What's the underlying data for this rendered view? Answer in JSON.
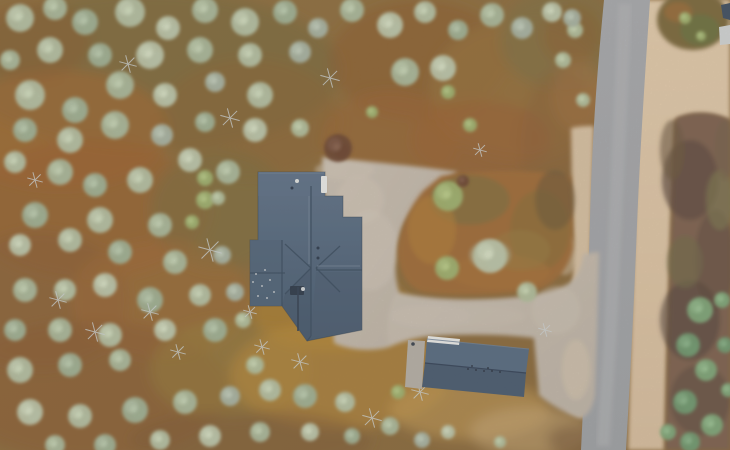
{
  "scene": {
    "width": 730,
    "height": 450,
    "description": "Top-down drone photo: dark-roofed cabin and small garage with light gravel yard and driveway, connecting to a gray gravel road on the right, surrounded by autumn pine forest and heathland"
  },
  "palette": {
    "ground_base_1": "#8e6f40",
    "ground_base_2": "#87673c",
    "road_1": "#a6a8ad",
    "road_2": "#9da0a5",
    "road_stripe": "#b6b8bb",
    "sand_left": "#d5bfa2",
    "sand_right_1": "#e1caac",
    "sand_right_2": "#d6bd9f",
    "gravel_1": "#c7bdb1",
    "gravel_2": "#bcb2a6",
    "island_base": "#9e6a38",
    "right_heath": "#7b6050",
    "corner_veg_1": "#7a683e",
    "corner_veg_2": "#6b713f",
    "corner_veg_3": "#9a6c3a",
    "roof_1": "#5f7289",
    "roof_2": "#51657c",
    "roof_3": "#475a70",
    "ridge": "#3a4c62",
    "roof_highlight": "#78899c",
    "garage_upper": "#566a82",
    "garage_lower": "#485a70",
    "white_detail": "#e8e9e8",
    "pad": "#b3aea6",
    "dead_tree": "#ccd2d4",
    "equipment_dark": "#2b3648",
    "tree_colors": [
      "#b3bfa3",
      "#a9b79b",
      "#9fb095",
      "#bac4aa",
      "#a6b2a2",
      "#b0bd9c",
      "#7da579",
      "#6f9870",
      "#9db06f",
      "#6b4634"
    ]
  },
  "paths": {
    "yard": "M322,157 C365,161 425,167 458,172 C440,183 414,201 402,228 C395,250 393,272 399,292 C403,312 397,332 389,347 C372,352 348,350 334,343 Z",
    "band": "M389,347 C385,324 389,305 397,292 C425,299 465,301 505,298 C535,296 555,291 568,284 C578,277 582,266 583,254 L599,252 L597,330 L595,395 C592,410 587,417 579,418 C563,412 548,403 539,395 L534,338 C505,334 465,334 432,336 C416,337 400,342 389,347 Z",
    "sand_left": "M571,128 C580,126 587,126 594,126 L591,240 L588,330 L585,418 C579,416 573,413 568,410 L571,330 L574,250 L572,190 Z",
    "sand_right": "M645,0 L730,0 L730,120 C710,112 690,112 674,120 C670,230 667,330 664,450 L628,450 C631,340 634,220 638,110 C640,70 643,30 645,0 Z",
    "road": "M604,0 L650,0 C645,75 640,150 637,225 C634,305 630,380 626,450 L581,450 C585,370 588,295 590,218 C592,140 597,72 604,0 Z",
    "road_center": "M625,4 C620,120 615,240 610,340 C607,390 605,420 603,446",
    "right_heath": "M676,118 C695,110 715,112 730,120 L730,450 L666,450 C668,340 671,230 676,118 Z",
    "island": "M441,176 C478,169 540,169 571,177 L573,248 C569,267 559,280 542,288 C510,295 462,297 423,292 C406,287 399,271 398,251 C400,229 410,205 424,190 Z",
    "house_footprint": "M258,172 L325,172 L325,196 L343,196 L343,217 L362,217 L362,330 L307,341 L282,306 L250,306 L250,240 L258,240 Z",
    "house_se_shade": "M316,272 L362,272 L362,330 L311,337 Z",
    "house_sw_shade": "M311,268 L285,294 L282,306 L307,341 L311,337 Z",
    "house_wing": "M250,240 L282,240 L282,306 L250,306 Z",
    "house_top": "M258,172 L325,172 L325,196 L258,196 Z",
    "garage_upper": "M427,339 L529,349 L526,373 L425,363 Z",
    "garage_lower": "M425,363 L526,373 L524,397 L422,387 Z",
    "garage_white": "M428,336 L460,339 L459,345 L427,342 Z",
    "garage_pad": "M408,340 L425,341 L422,389 L405,387 Z",
    "neighbor_roof": "M721,5 L730,3 L730,20 L723,18 Z",
    "neighbor_panel": "M719,27 L730,25 L730,44 L720,45 Z"
  },
  "ground_patches": [
    [
      150,
      70,
      190,
      80,
      "#7b6a3c",
      0.75
    ],
    [
      60,
      130,
      110,
      60,
      "#a4672f",
      0.6
    ],
    [
      250,
      120,
      90,
      60,
      "#8a6434",
      0.55
    ],
    [
      420,
      60,
      90,
      60,
      "#8d5a2e",
      0.5
    ],
    [
      520,
      90,
      90,
      70,
      "#96713d",
      0.7
    ],
    [
      560,
      40,
      60,
      50,
      "#7d6f45",
      0.6
    ],
    [
      480,
      140,
      70,
      40,
      "#9c5c30",
      0.5
    ],
    [
      90,
      210,
      120,
      70,
      "#9a5f2e",
      0.6
    ],
    [
      220,
      210,
      70,
      60,
      "#7a6d3f",
      0.55
    ],
    [
      40,
      300,
      90,
      70,
      "#8a5c34",
      0.55
    ],
    [
      160,
      300,
      90,
      60,
      "#a06a33",
      0.5
    ],
    [
      90,
      390,
      140,
      70,
      "#8a5c34",
      0.6
    ],
    [
      230,
      370,
      80,
      50,
      "#97803d",
      0.5
    ],
    [
      330,
      310,
      80,
      40,
      "#b5862f",
      0.6
    ],
    [
      340,
      375,
      110,
      55,
      "#b98a3c",
      0.6
    ],
    [
      470,
      410,
      80,
      30,
      "#c29a55",
      0.6
    ],
    [
      530,
      432,
      60,
      25,
      "#c7a878",
      0.55
    ],
    [
      390,
      140,
      70,
      50,
      "#9c6432",
      0.5
    ],
    [
      560,
      150,
      40,
      80,
      "#8a6038",
      0.5
    ],
    [
      572,
      35,
      30,
      30,
      "#8a5e32",
      0.55
    ],
    [
      578,
      95,
      26,
      36,
      "#a27040",
      0.5
    ],
    [
      250,
      440,
      120,
      30,
      "#7e5a36",
      0.5
    ],
    [
      30,
      40,
      60,
      40,
      "#8a5c30",
      0.5
    ],
    [
      360,
      230,
      40,
      60,
      "#8a7340",
      0.45
    ],
    [
      575,
      440,
      28,
      16,
      "#7a5a3c",
      0.6
    ]
  ],
  "island_patches": [
    [
      470,
      200,
      40,
      25,
      "#7f6f3e",
      0.7
    ],
    [
      540,
      230,
      30,
      40,
      "#8a6d3a",
      0.7
    ],
    [
      500,
      272,
      50,
      18,
      "#a4713a",
      0.7
    ],
    [
      555,
      200,
      20,
      30,
      "#6d583a",
      0.6
    ],
    [
      432,
      230,
      24,
      34,
      "#b07e38",
      0.6
    ],
    [
      520,
      250,
      30,
      20,
      "#967a40",
      0.5
    ],
    [
      490,
      255,
      20,
      14,
      "#b5bfa3",
      0.55
    ]
  ],
  "right_heath_patches": [
    [
      690,
      180,
      28,
      40,
      "#5e4a3e",
      0.7
    ],
    [
      715,
      260,
      20,
      50,
      "#665042",
      0.7
    ],
    [
      690,
      320,
      30,
      40,
      "#55463c",
      0.6
    ],
    [
      700,
      400,
      30,
      35,
      "#604c40",
      0.6
    ],
    [
      720,
      200,
      14,
      30,
      "#7d7a52",
      0.6
    ],
    [
      685,
      262,
      18,
      26,
      "#716b4a",
      0.6
    ],
    [
      672,
      150,
      12,
      30,
      "#6b563f",
      0.6
    ],
    [
      725,
      150,
      10,
      30,
      "#74604a",
      0.5
    ]
  ],
  "corner_veg": [
    [
      693,
      20,
      36,
      30,
      "#7a683e",
      1
    ],
    [
      700,
      30,
      20,
      16,
      "#6b713f",
      0.9
    ],
    [
      678,
      12,
      14,
      10,
      "#9a6c3a",
      0.8
    ]
  ],
  "gravel_blotches": [
    [
      370,
      250,
      28,
      40,
      "#cfc6ba",
      0.5
    ],
    [
      430,
      316,
      40,
      12,
      "#ccc2b6",
      0.5
    ],
    [
      475,
      316,
      50,
      10,
      "#c9bfb2",
      0.4
    ],
    [
      360,
      200,
      24,
      24,
      "#d2c8bb",
      0.45
    ],
    [
      556,
      310,
      24,
      24,
      "#cdc3b6",
      0.4
    ],
    [
      576,
      370,
      14,
      30,
      "#d6c5af",
      0.5
    ],
    [
      345,
      170,
      30,
      10,
      "#cfc5b8",
      0.5
    ],
    [
      565,
      255,
      12,
      20,
      "#d8c6ae",
      0.5
    ]
  ],
  "trees": [
    [
      20,
      18,
      14,
      0
    ],
    [
      55,
      8,
      12,
      1
    ],
    [
      85,
      22,
      13,
      2
    ],
    [
      130,
      12,
      15,
      0
    ],
    [
      168,
      28,
      12,
      3
    ],
    [
      205,
      10,
      13,
      1
    ],
    [
      245,
      22,
      14,
      0
    ],
    [
      285,
      12,
      12,
      2
    ],
    [
      318,
      28,
      10,
      4
    ],
    [
      352,
      10,
      12,
      1
    ],
    [
      390,
      25,
      13,
      3
    ],
    [
      425,
      12,
      11,
      0
    ],
    [
      458,
      30,
      10,
      2
    ],
    [
      492,
      15,
      12,
      1
    ],
    [
      522,
      28,
      11,
      4
    ],
    [
      552,
      12,
      10,
      3
    ],
    [
      10,
      60,
      10,
      1
    ],
    [
      50,
      50,
      13,
      0
    ],
    [
      100,
      55,
      12,
      2
    ],
    [
      150,
      55,
      14,
      3
    ],
    [
      200,
      50,
      13,
      1
    ],
    [
      250,
      55,
      12,
      0
    ],
    [
      300,
      52,
      11,
      4
    ],
    [
      575,
      30,
      8,
      5
    ],
    [
      30,
      95,
      15,
      0
    ],
    [
      75,
      110,
      13,
      2
    ],
    [
      120,
      85,
      14,
      1
    ],
    [
      165,
      95,
      12,
      3
    ],
    [
      215,
      82,
      10,
      4
    ],
    [
      260,
      95,
      13,
      0
    ],
    [
      405,
      72,
      14,
      1
    ],
    [
      443,
      68,
      13,
      3
    ],
    [
      448,
      92,
      7,
      8
    ],
    [
      25,
      130,
      12,
      2
    ],
    [
      70,
      140,
      13,
      0
    ],
    [
      115,
      125,
      14,
      1
    ],
    [
      162,
      135,
      11,
      4
    ],
    [
      205,
      122,
      10,
      2
    ],
    [
      255,
      130,
      12,
      3
    ],
    [
      300,
      128,
      9,
      5
    ],
    [
      338,
      148,
      14,
      9
    ],
    [
      372,
      112,
      6,
      8
    ],
    [
      563,
      60,
      8,
      5
    ],
    [
      572,
      18,
      9,
      4
    ],
    [
      583,
      100,
      7,
      5
    ],
    [
      15,
      162,
      11,
      0
    ],
    [
      60,
      172,
      13,
      1
    ],
    [
      95,
      185,
      12,
      2
    ],
    [
      140,
      180,
      13,
      0
    ],
    [
      190,
      160,
      12,
      3
    ],
    [
      228,
      172,
      12,
      1
    ],
    [
      35,
      215,
      13,
      2
    ],
    [
      100,
      220,
      13,
      0
    ],
    [
      160,
      225,
      12,
      1
    ],
    [
      205,
      200,
      9,
      8
    ],
    [
      20,
      245,
      11,
      3
    ],
    [
      70,
      240,
      12,
      0
    ],
    [
      120,
      252,
      12,
      2
    ],
    [
      175,
      262,
      12,
      1
    ],
    [
      222,
      255,
      9,
      4
    ],
    [
      205,
      178,
      8,
      8
    ],
    [
      218,
      198,
      7,
      5
    ],
    [
      192,
      222,
      7,
      8
    ],
    [
      25,
      290,
      12,
      1
    ],
    [
      65,
      290,
      11,
      0
    ],
    [
      105,
      285,
      12,
      3
    ],
    [
      150,
      300,
      13,
      2
    ],
    [
      200,
      295,
      11,
      0
    ],
    [
      235,
      292,
      9,
      4
    ],
    [
      15,
      330,
      11,
      2
    ],
    [
      60,
      330,
      12,
      1
    ],
    [
      110,
      335,
      12,
      0
    ],
    [
      165,
      330,
      11,
      3
    ],
    [
      215,
      330,
      12,
      2
    ],
    [
      243,
      320,
      8,
      5
    ],
    [
      20,
      370,
      13,
      0
    ],
    [
      70,
      365,
      12,
      2
    ],
    [
      120,
      360,
      11,
      1
    ],
    [
      30,
      412,
      13,
      3
    ],
    [
      80,
      416,
      12,
      0
    ],
    [
      135,
      410,
      13,
      2
    ],
    [
      185,
      402,
      12,
      1
    ],
    [
      230,
      396,
      10,
      4
    ],
    [
      255,
      365,
      9,
      5
    ],
    [
      270,
      390,
      11,
      0
    ],
    [
      305,
      396,
      12,
      2
    ],
    [
      260,
      432,
      10,
      1
    ],
    [
      210,
      436,
      11,
      3
    ],
    [
      160,
      440,
      10,
      0
    ],
    [
      105,
      445,
      11,
      2
    ],
    [
      55,
      445,
      10,
      1
    ],
    [
      310,
      432,
      9,
      3
    ],
    [
      345,
      402,
      10,
      0
    ],
    [
      352,
      436,
      8,
      2
    ],
    [
      390,
      426,
      9,
      1
    ],
    [
      398,
      392,
      7,
      8
    ],
    [
      422,
      440,
      8,
      4
    ],
    [
      448,
      432,
      7,
      3
    ],
    [
      500,
      442,
      6,
      5
    ],
    [
      448,
      196,
      15,
      8
    ],
    [
      490,
      256,
      17,
      3
    ],
    [
      447,
      268,
      12,
      8
    ],
    [
      527,
      292,
      10,
      5
    ],
    [
      463,
      181,
      6,
      9
    ],
    [
      470,
      125,
      7,
      8
    ],
    [
      700,
      310,
      13,
      6
    ],
    [
      688,
      345,
      12,
      7
    ],
    [
      706,
      370,
      11,
      6
    ],
    [
      685,
      402,
      12,
      7
    ],
    [
      712,
      425,
      11,
      6
    ],
    [
      690,
      442,
      10,
      7
    ],
    [
      668,
      432,
      8,
      6
    ],
    [
      725,
      345,
      8,
      7
    ],
    [
      722,
      300,
      8,
      6
    ],
    [
      728,
      390,
      7,
      6
    ],
    [
      685,
      18,
      6,
      8
    ],
    [
      701,
      36,
      5,
      8
    ]
  ],
  "dead_trees": [
    [
      210,
      250,
      12
    ],
    [
      95,
      332,
      10
    ],
    [
      150,
      312,
      9
    ],
    [
      230,
      118,
      10
    ],
    [
      128,
      64,
      9
    ],
    [
      330,
      78,
      10
    ],
    [
      58,
      300,
      9
    ],
    [
      262,
      347,
      8
    ],
    [
      300,
      362,
      9
    ],
    [
      372,
      418,
      10
    ],
    [
      420,
      392,
      9
    ],
    [
      178,
      352,
      8
    ],
    [
      480,
      150,
      7
    ],
    [
      545,
      330,
      7
    ],
    [
      35,
      180,
      8
    ],
    [
      250,
      312,
      7
    ]
  ],
  "house": {
    "ridges": [
      "M311,186 L311,336",
      "M311,268 L285,244",
      "M311,268 L285,294",
      "M316,268 L340,246",
      "M316,268 L340,292",
      "M316,270 L362,270",
      "M250,273 L285,273",
      "M311,336 L307,341",
      "M282,240 L282,306"
    ],
    "highlights": [
      "M309,196 L309,264",
      "M317,266 L360,266",
      "M259,173 L324,173"
    ],
    "chimney": [
      321,
      176,
      6,
      17
    ],
    "white_vent": [
      297,
      181,
      2
    ],
    "dark_vent": [
      292,
      188,
      1.5
    ],
    "wing_dots": [
      [
        256,
        274
      ],
      [
        262,
        286
      ],
      [
        270,
        280
      ],
      [
        258,
        296
      ],
      [
        267,
        298
      ],
      [
        274,
        292
      ],
      [
        253,
        282
      ],
      [
        265,
        270
      ]
    ],
    "roof_dots": [
      [
        318,
        248
      ],
      [
        318,
        258
      ]
    ],
    "equipment_box": [
      290,
      286,
      14,
      9
    ],
    "equipment_line": "M298,287 L298,331",
    "equipment_dot": [
      303,
      289,
      2
    ]
  },
  "garage": {
    "ridge": "M425,363 L526,373",
    "top_edge": "M427,339 L529,349",
    "dots": [
      [
        468,
        369
      ],
      [
        476,
        370
      ],
      [
        484,
        371
      ],
      [
        492,
        371
      ],
      [
        500,
        372
      ],
      [
        472,
        366
      ],
      [
        488,
        368
      ]
    ],
    "pad_dot": [
      413,
      344,
      1.8
    ]
  }
}
